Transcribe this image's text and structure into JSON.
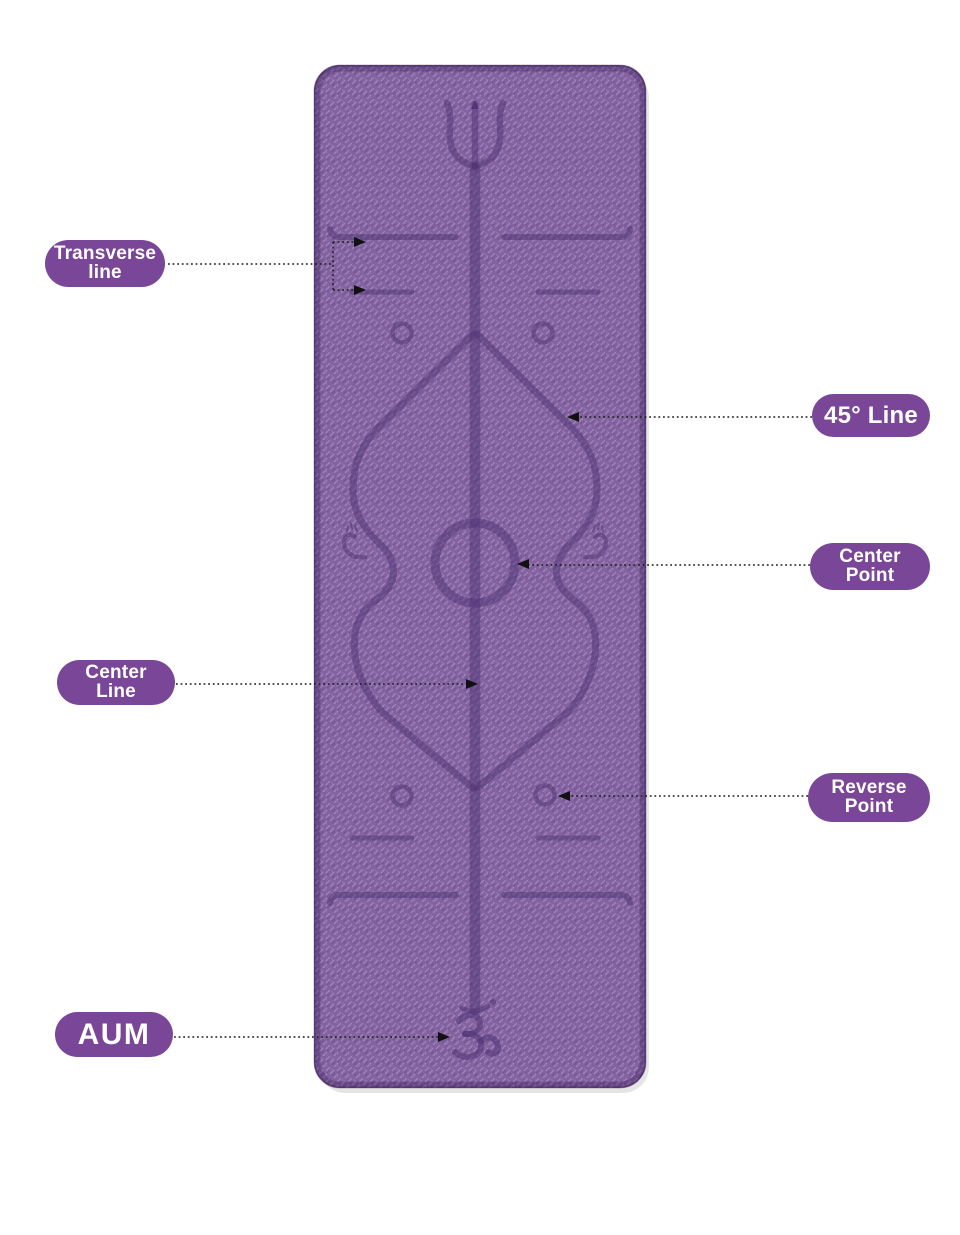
{
  "page": {
    "background_color": "#ffffff",
    "description": "Yoga mat body-alignment guide diagram with callout labels"
  },
  "mat": {
    "base_color": "#83629f",
    "texture_light_color": "#9d84bb",
    "texture_dark_color": "#6f5490",
    "engraving_color": "#4f3375",
    "engravings": [
      "trident-symbol",
      "center-line",
      "transverse-lines",
      "45-degree-lines",
      "center-circle",
      "reverse-point-circles",
      "side-swirls",
      "om-symbol"
    ]
  },
  "callouts": [
    {
      "id": "transverse-line",
      "lines": [
        "Transverse",
        "line"
      ],
      "side": "left"
    },
    {
      "id": "45-line",
      "lines": [
        "45° Line"
      ],
      "side": "right"
    },
    {
      "id": "center-point",
      "lines": [
        "Center",
        "Point"
      ],
      "side": "right"
    },
    {
      "id": "center-line",
      "lines": [
        "Center",
        "Line"
      ],
      "side": "left"
    },
    {
      "id": "reverse-point",
      "lines": [
        "Reverse",
        "Point"
      ],
      "side": "right"
    },
    {
      "id": "aum",
      "lines": [
        "AUM"
      ],
      "side": "left"
    }
  ],
  "colors": {
    "badge_background": "#7a4697",
    "badge_text": "#ffffff",
    "connector_line": "#1c1c1c"
  }
}
